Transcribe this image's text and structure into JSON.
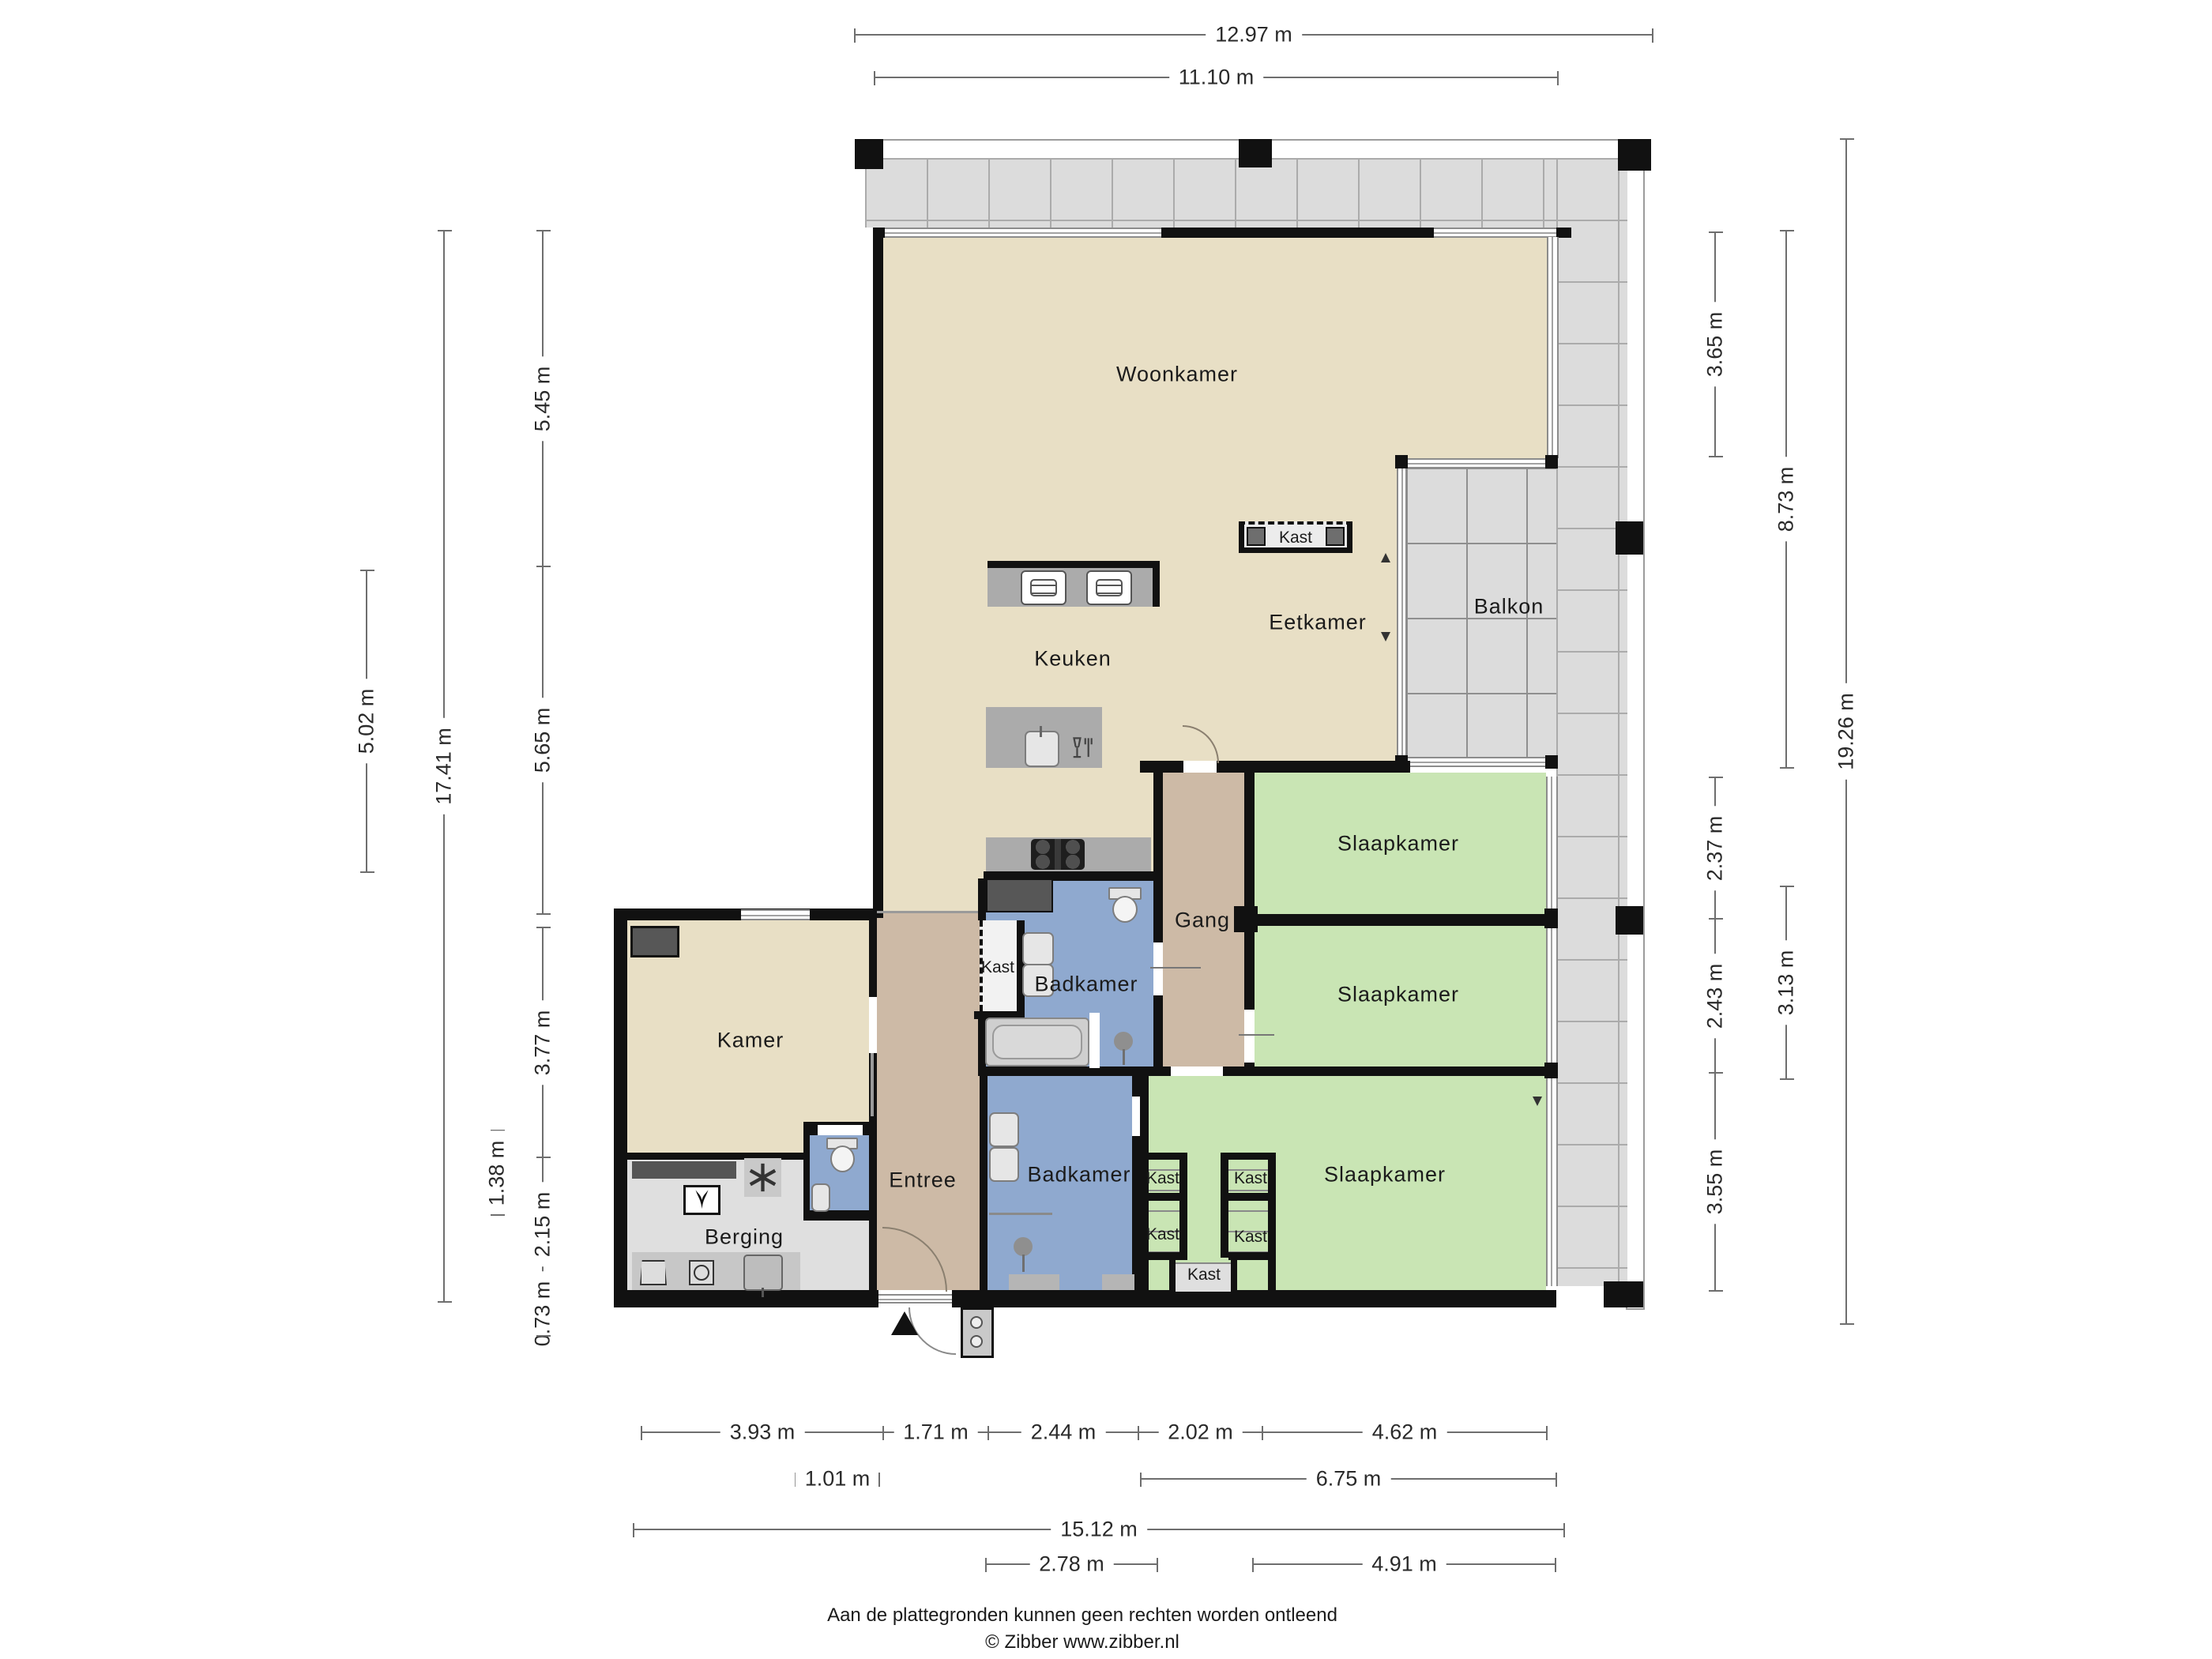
{
  "rooms": {
    "woonkamer": "Woonkamer",
    "eetkamer": "Eetkamer",
    "keuken": "Keuken",
    "balkon": "Balkon",
    "slaapkamer": "Slaapkamer",
    "gang": "Gang",
    "badkamer": "Badkamer",
    "kast": "Kast",
    "kamer": "Kamer",
    "entree": "Entree",
    "berging": "Berging"
  },
  "dimensions": {
    "top": [
      "12.97 m",
      "11.10 m"
    ],
    "left": [
      "5.45 m",
      "5.65 m",
      "3.77 m",
      "2.15 m",
      "0.73 m",
      "17.41 m",
      "5.02 m",
      "1.38 m"
    ],
    "right": [
      "3.65 m",
      "2.37 m",
      "2.43 m",
      "3.55 m",
      "8.73 m",
      "3.13 m",
      "19.26 m"
    ],
    "bottom": [
      "3.93 m",
      "1.71 m",
      "2.44 m",
      "2.02 m",
      "4.62 m",
      "1.01 m",
      "6.75 m",
      "15.12 m",
      "2.78 m",
      "4.91 m"
    ]
  },
  "footer": {
    "disclaimer": "Aan de plattegronden kunnen geen rechten worden ontleend",
    "copyright": "© Zibber www.zibber.nl"
  },
  "colors": {
    "wall": "#111111",
    "floor_living": "#E8DFC5",
    "floor_bedroom": "#C9E5B4",
    "floor_bath": "#8FA9CF",
    "floor_hall": "#CDBAA6",
    "floor_storage": "#DFDFDF",
    "floor_balcony": "#DCDCDC",
    "counter": "#ABABAB"
  }
}
